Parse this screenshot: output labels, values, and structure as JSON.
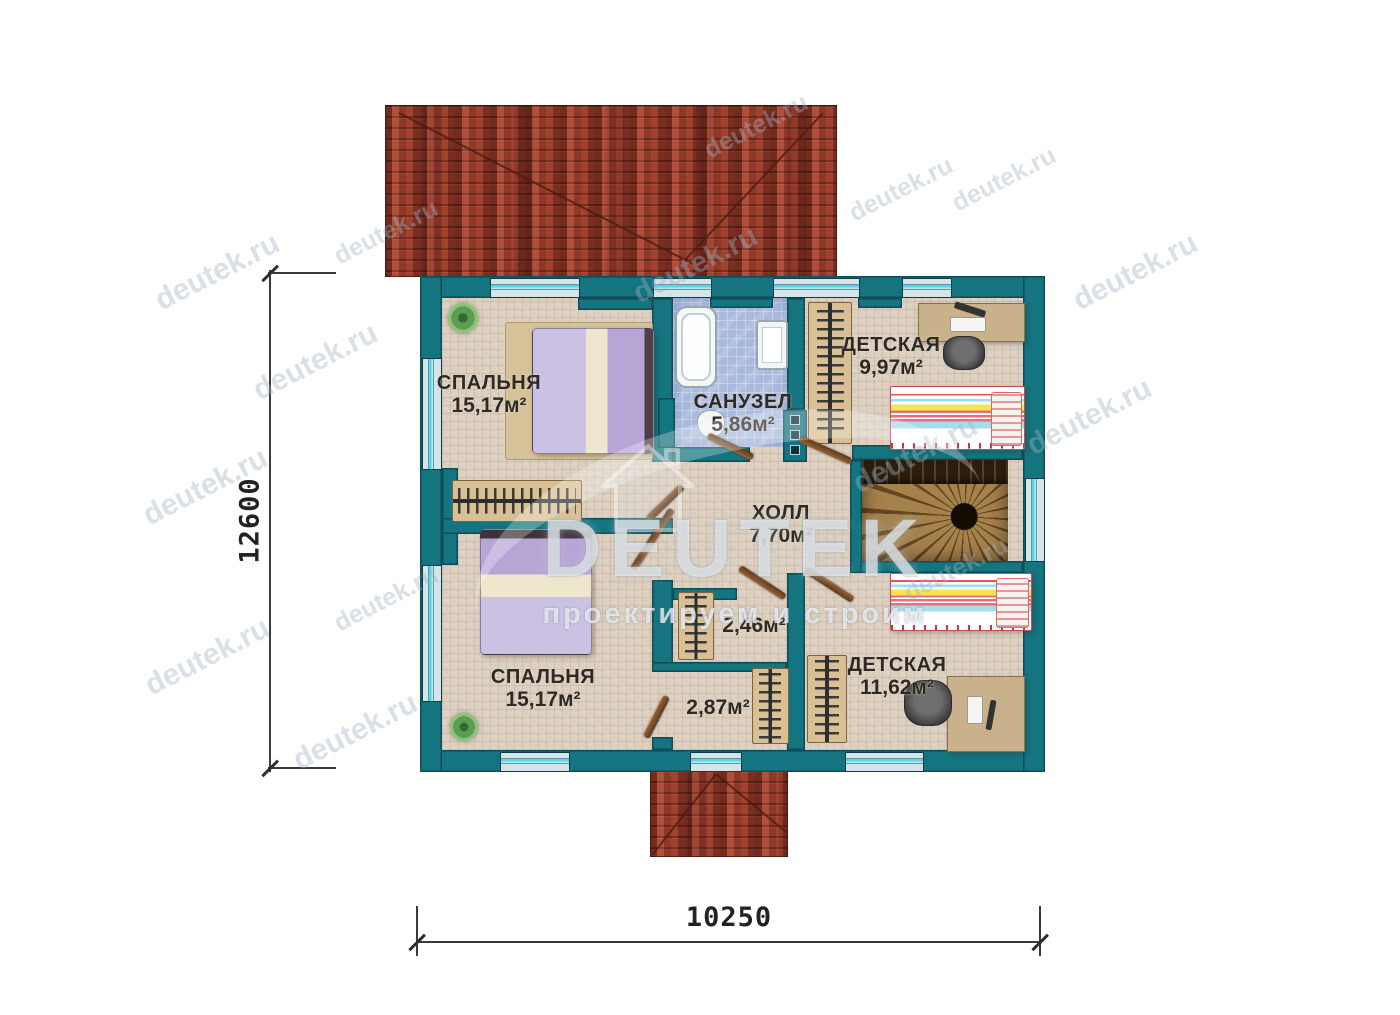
{
  "floor_plan": {
    "rooms": [
      {
        "id": "bedroom-1",
        "name": "СПАЛЬНЯ",
        "area": "15,17м²"
      },
      {
        "id": "bedroom-2",
        "name": "СПАЛЬНЯ",
        "area": "15,17м²"
      },
      {
        "id": "bathroom",
        "name": "САНУЗЕЛ",
        "area": "5,86м²"
      },
      {
        "id": "kids-room-1",
        "name": "ДЕТСКАЯ",
        "area": "9,97м²"
      },
      {
        "id": "kids-room-2",
        "name": "ДЕТСКАЯ",
        "area": "11,62м²"
      },
      {
        "id": "hall",
        "name": "ХОЛЛ",
        "area": "7,70м²"
      },
      {
        "id": "closet-1",
        "name": "",
        "area": "2,46м²"
      },
      {
        "id": "closet-2",
        "name": "",
        "area": "2,87м²"
      }
    ],
    "dimensions": {
      "vertical": "12600",
      "horizontal": "10250"
    }
  },
  "watermark": {
    "text": "deutek.ru"
  },
  "logo": {
    "name": "DEUTEK",
    "tagline": "проектируем и строим"
  },
  "colors": {
    "wall": "#14747f",
    "roof": "#a0422f",
    "window_accent": "#4fd9e8",
    "floor": "#dccfbf",
    "bath_tile": "#a9badd"
  }
}
